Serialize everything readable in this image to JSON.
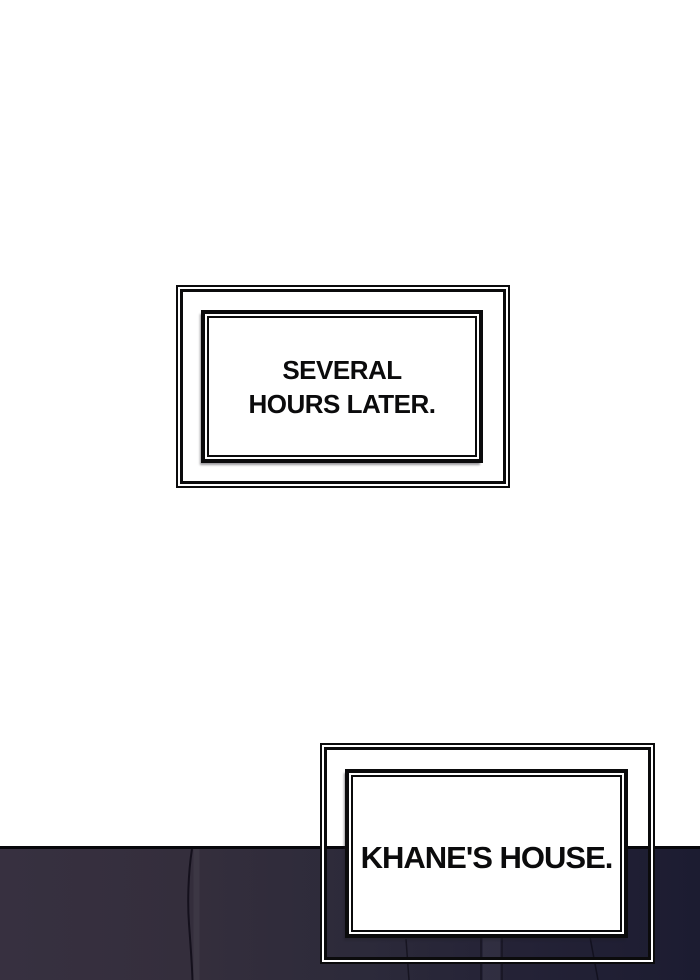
{
  "comic": {
    "caption_boxes": [
      {
        "name": "time-skip",
        "lines": [
          "SEVERAL",
          "HOURS LATER."
        ]
      },
      {
        "name": "location",
        "lines": [
          "KHANE'S HOUSE."
        ]
      }
    ],
    "colors": {
      "ink": "#0b0b0c",
      "paper": "#ffffff",
      "night_wall_left": "#373040",
      "night_wall_right": "#1c1c31",
      "horizon_line": "#07070b"
    }
  }
}
